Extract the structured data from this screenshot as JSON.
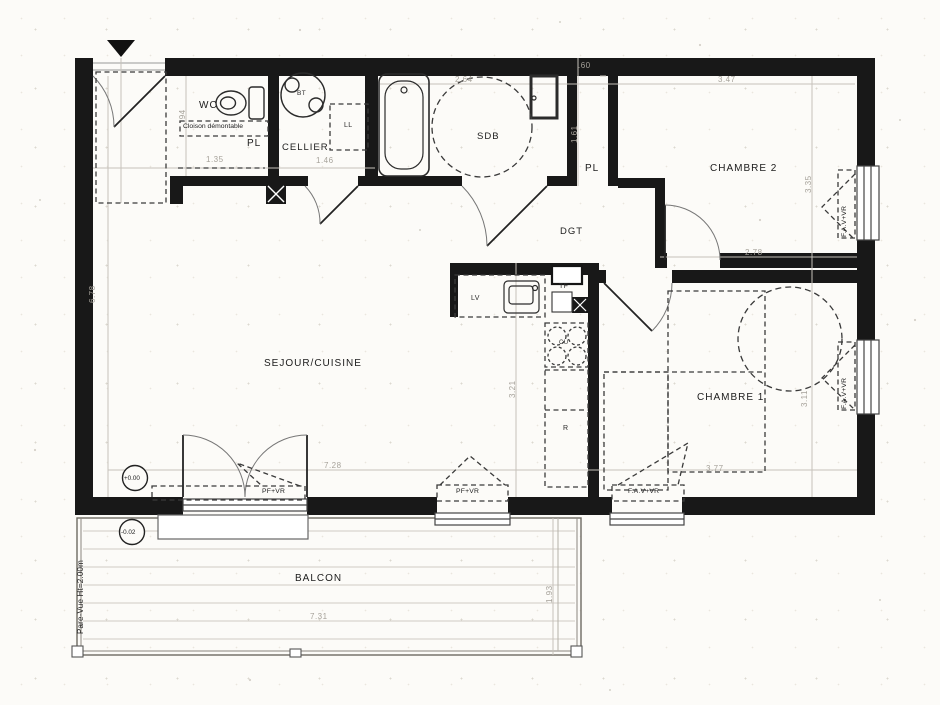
{
  "plan": {
    "rooms": {
      "sejour": "SEJOUR/CUISINE",
      "wc": "WC",
      "cellier": "CELLIER",
      "sdb": "SDB",
      "dgt": "DGT",
      "chambre2": "CHAMBRE 2",
      "chambre1": "CHAMBRE 1",
      "balcon": "BALCON"
    },
    "closets": {
      "wc_pl": "PL",
      "dgt_pl": "PL"
    },
    "equipment": {
      "ll": "LL",
      "bt": "BT",
      "lv": "LV",
      "tf": "TF",
      "cu": "CU",
      "refrigerator": "R"
    },
    "notes": {
      "cloison": "Cloison démontable",
      "pare_vue": "Pare-Vue Ht=2.00m"
    },
    "levels": {
      "interior": "+0.00",
      "balcon": "-0.02"
    },
    "openings": {
      "sejour_door": "PF+VR",
      "sejour_window": "PF+VR",
      "ch1_south_window": "F.A.V+VR",
      "ch1_east_window": "F.A.V+VR",
      "ch2_east_window": "F.A.V+VR"
    },
    "dimensions": {
      "sdb_width": "2.64",
      "pl_width": ".60",
      "ch2_width": "3.47",
      "wc_depth": ".94",
      "wc_pl_width": "1.35",
      "cellier_width": "1.46",
      "sdb_depth": "1.61",
      "ch2_depth": "3.35",
      "ch2_inner_width": "2.78",
      "sejour_width": "7.28",
      "sejour_depth": "6.78",
      "cuisine_depth": "3.21",
      "ch1_width": "3.77",
      "ch1_depth": "3.11",
      "balcon_width": "7.31",
      "balcon_depth": "1.93"
    }
  }
}
